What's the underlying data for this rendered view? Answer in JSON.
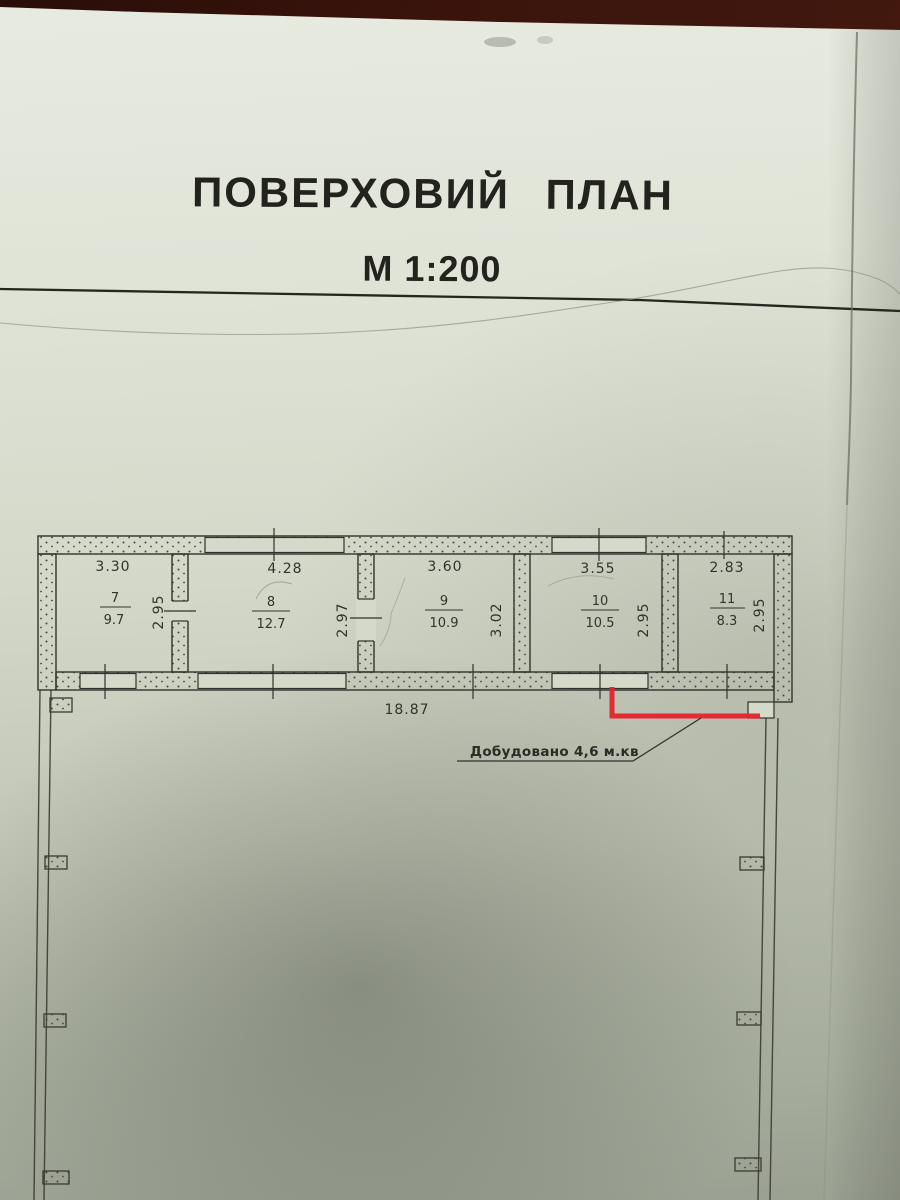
{
  "document": {
    "title": "ПОВЕРХОВИЙ ПЛАН",
    "scale_label": "М 1:200"
  },
  "plan": {
    "rooms": [
      {
        "number": "7",
        "area": "9.7",
        "width_dim": "3.30",
        "depth_dim": "2.95"
      },
      {
        "number": "8",
        "area": "12.7",
        "width_dim": "4.28",
        "depth_dim": "2.97"
      },
      {
        "number": "9",
        "area": "10.9",
        "width_dim": "3.60",
        "depth_dim": "3.02"
      },
      {
        "number": "10",
        "area": "10.5",
        "width_dim": "3.55",
        "depth_dim": "2.95"
      },
      {
        "number": "11",
        "area": "8.3",
        "width_dim": "2.83",
        "depth_dim": "2.95"
      }
    ],
    "overall_length_dim": "18.87",
    "annotation_text": "Добудовано 4,6 м.кв",
    "colors": {
      "ink": "#32322c",
      "red_highlight": "#e8222a",
      "paper": "#d9ddd0",
      "table_background": "#31100a"
    }
  }
}
